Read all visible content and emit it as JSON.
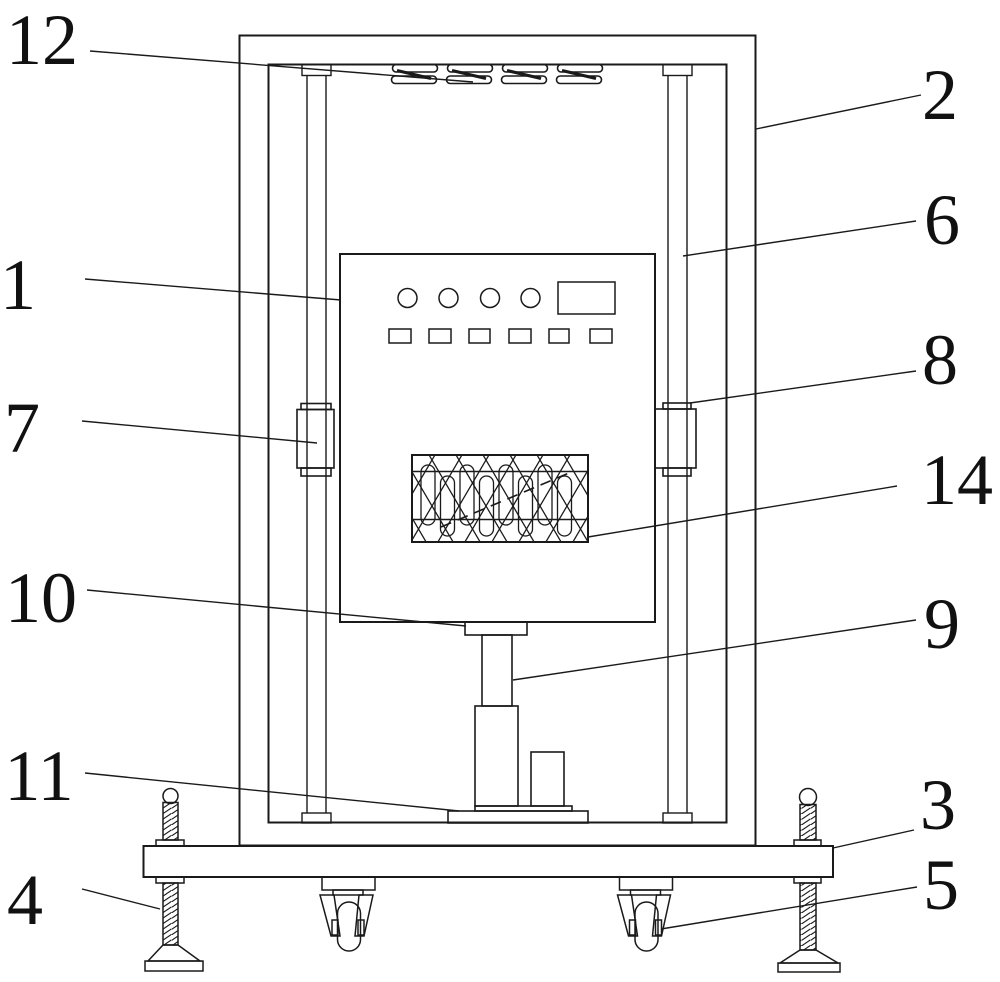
{
  "figure": {
    "background": "#ffffff",
    "line_color": "#1a1a1a",
    "label_color": "#111111"
  },
  "labels": {
    "n1": "1",
    "n2": "2",
    "n3": "3",
    "n4": "4",
    "n5": "5",
    "n6": "6",
    "n7": "7",
    "n8": "8",
    "n9": "9",
    "n10": "10",
    "n11": "11",
    "n12": "12",
    "n14": "14"
  }
}
